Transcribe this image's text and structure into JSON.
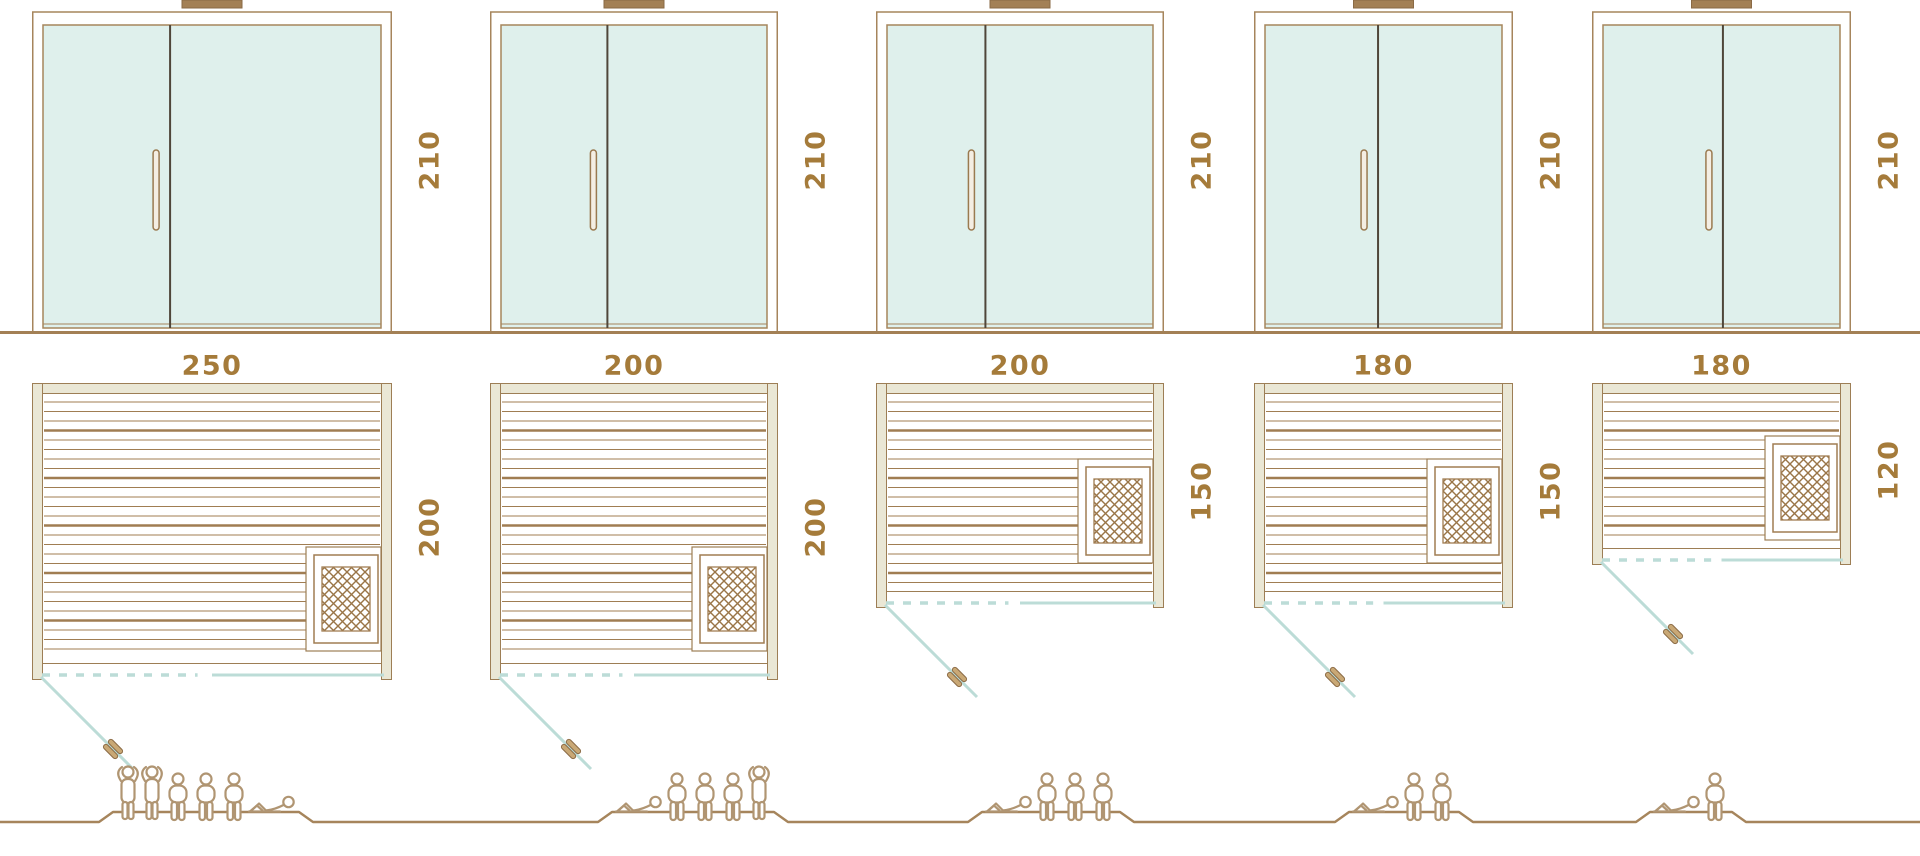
{
  "diagram_name": "sauna-size-comparison",
  "colors": {
    "line_brown": "#a6855c",
    "ground_brown": "#a38055",
    "label_text": "#a57b3a",
    "glass_mint": "#dff0ec",
    "door_divider": "#4f463a",
    "wall_beige_fill": "#eae7d5",
    "wall_stroke": "#9d7e55",
    "slat_brown": "#a07d52",
    "heater_hatch": "#9a7547",
    "door_swing_teal": "#bcdcd7",
    "figure_outline": "#b09572",
    "handle_fill": "#c9a875"
  },
  "models": [
    {
      "name": "sauna-250x200",
      "width_cm": "250",
      "depth_cm": "200",
      "door_height_cm": "210",
      "capacity": {
        "standing": 2,
        "sitting": 3,
        "lying": 1
      },
      "figure_order": [
        "standing",
        "standing",
        "sitting",
        "sitting",
        "sitting",
        "lying"
      ]
    },
    {
      "name": "sauna-200x200",
      "width_cm": "200",
      "depth_cm": "200",
      "door_height_cm": "210",
      "capacity": {
        "standing": 1,
        "sitting": 3,
        "lying": 1
      },
      "figure_order": [
        "lying",
        "sitting",
        "sitting",
        "sitting",
        "standing"
      ]
    },
    {
      "name": "sauna-200x150",
      "width_cm": "200",
      "depth_cm": "150",
      "door_height_cm": "210",
      "capacity": {
        "standing": 0,
        "sitting": 3,
        "lying": 1
      },
      "figure_order": [
        "lying",
        "sitting",
        "sitting",
        "sitting"
      ]
    },
    {
      "name": "sauna-180x150",
      "width_cm": "180",
      "depth_cm": "150",
      "door_height_cm": "210",
      "capacity": {
        "standing": 0,
        "sitting": 2,
        "lying": 1
      },
      "figure_order": [
        "lying",
        "sitting",
        "sitting"
      ]
    },
    {
      "name": "sauna-180x120",
      "width_cm": "180",
      "depth_cm": "120",
      "door_height_cm": "210",
      "capacity": {
        "standing": 0,
        "sitting": 1,
        "lying": 1
      },
      "figure_order": [
        "lying",
        "sitting"
      ]
    }
  ]
}
